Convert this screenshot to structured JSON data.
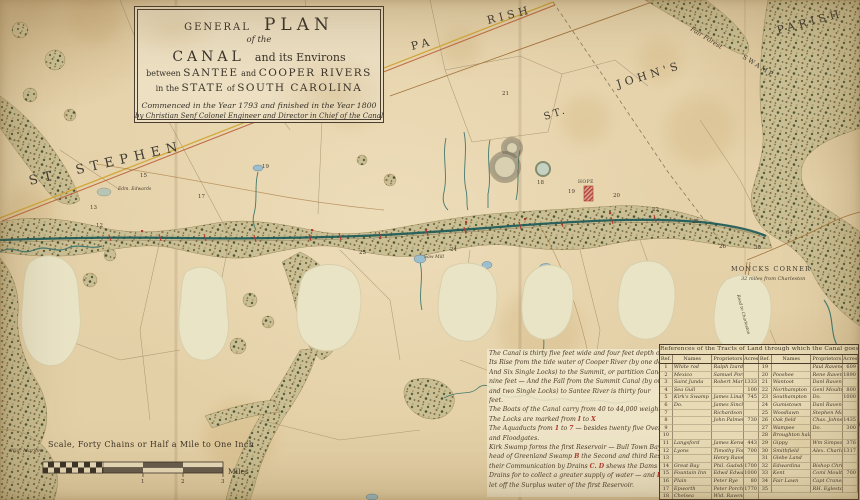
{
  "cartouche": {
    "l1a": "GENERAL",
    "l1b": "PLAN",
    "l2": "of the",
    "l3a": "CANAL",
    "l3b": "and its Environs",
    "l4a": "between",
    "l4b": "SANTEE",
    "l4c": "and",
    "l4d": "COOPER RIVERS",
    "l5a": "in the",
    "l5b": "STATE",
    "l5c": "of",
    "l5d": "SOUTH CAROLINA",
    "l6": "Commenced in the Year 1793 and finished in the Year 1800",
    "l7": "by Christian Senf Colonel Engineer and Director in Chief of the Canal"
  },
  "map_labels": [
    {
      "text": "ST. STEPHEN"
    },
    {
      "text": "PA"
    },
    {
      "text": "RISH"
    },
    {
      "text": "ST."
    },
    {
      "text": "JOHN'S"
    },
    {
      "text": "PARISH"
    },
    {
      "text": "Fair Forest"
    },
    {
      "text": "SWAMP"
    },
    {
      "text": "MONCKS CORNER"
    },
    {
      "text": "32 miles from Charleston"
    },
    {
      "text": "Road to Charleston"
    },
    {
      "text": "Edm. Edwards"
    },
    {
      "text": "Saw Mill"
    },
    {
      "text": "HOPE"
    },
    {
      "text": "Wid. Marion"
    }
  ],
  "tract_numbers": [
    {
      "n": "12",
      "x": 96,
      "y": 227
    },
    {
      "n": "13",
      "x": 90,
      "y": 209
    },
    {
      "n": "15",
      "x": 140,
      "y": 177
    },
    {
      "n": "17",
      "x": 198,
      "y": 198
    },
    {
      "n": "19",
      "x": 262,
      "y": 168
    },
    {
      "n": "21",
      "x": 502,
      "y": 95
    },
    {
      "n": "18",
      "x": 537,
      "y": 184
    },
    {
      "n": "19",
      "x": 568,
      "y": 193
    },
    {
      "n": "20",
      "x": 613,
      "y": 197
    },
    {
      "n": "22",
      "x": 652,
      "y": 211
    },
    {
      "n": "23",
      "x": 359,
      "y": 254
    },
    {
      "n": "24",
      "x": 450,
      "y": 251
    },
    {
      "n": "25",
      "x": 692,
      "y": 223
    },
    {
      "n": "26",
      "x": 719,
      "y": 248
    },
    {
      "n": "30",
      "x": 754,
      "y": 249
    },
    {
      "n": "34",
      "x": 786,
      "y": 234
    }
  ],
  "notes": {
    "lines": [
      [
        {
          "t": "The Canal is thirty five feet wide and four feet depth of water."
        }
      ],
      [
        {
          "t": "Its Rise from the tide water of Cooper River (by one double"
        }
      ],
      [
        {
          "t": "And Six Single Locks) to the Summit, or partition Canal is Sixty"
        }
      ],
      [
        {
          "t": "nine feet — And the Fall from the Summit Canal (by one double"
        }
      ],
      [
        {
          "t": "and two Single Locks) to Santee River is thirty four"
        }
      ],
      [
        {
          "t": "feet."
        }
      ],
      [
        {
          "t": "The Boats of the Canal carry from 40 to 44,000 weight."
        }
      ],
      [
        {
          "t": "The Locks are marked from "
        },
        {
          "t": "I",
          "r": 1
        },
        {
          "t": " to "
        },
        {
          "t": "X",
          "r": 1
        }
      ],
      [
        {
          "t": "The Aquaducts from "
        },
        {
          "t": "1",
          "r": 1
        },
        {
          "t": " to "
        },
        {
          "t": "7",
          "r": 1
        },
        {
          "t": " — besides twenty five Overfalls"
        }
      ],
      [
        {
          "t": "and Floodgates."
        }
      ],
      [
        {
          "t": "Kirk Swamp forms the first Reservoir — Bull Town Bays and the"
        }
      ],
      [
        {
          "t": "head of Greenland Swamp "
        },
        {
          "t": "B",
          "r": 1
        },
        {
          "t": " the Second and third Reservoir"
        }
      ],
      [
        {
          "t": "their Communication by Drains "
        },
        {
          "t": "C. D",
          "r": 1
        },
        {
          "t": " shews the Dams and "
        },
        {
          "t": "C",
          "r": 1
        },
        {
          "t": " the"
        }
      ],
      [
        {
          "t": "Drains for to collect a greater supply of water — and "
        },
        {
          "t": "E",
          "r": 1
        },
        {
          "t": " the Drain to"
        }
      ],
      [
        {
          "t": "let off the Surplus water of the first Reservoir."
        }
      ]
    ]
  },
  "reference_table": {
    "title": "References of the Tracts of Land through which the Canal goes",
    "columns": [
      "Ref.",
      "Names",
      "Proprietors",
      "Acres"
    ],
    "left_rows": [
      [
        "1",
        "White rod",
        "Ralph Izard Esq",
        ""
      ],
      [
        "2",
        "Mexico",
        "Samuel Porcher",
        ""
      ],
      [
        "3",
        "Saint Junda",
        "Robert Marion",
        "1333"
      ],
      [
        "4",
        "Sea Gull",
        "",
        "100"
      ],
      [
        "5",
        "Kirk's Swamp",
        "James Linah",
        "745"
      ],
      [
        "6",
        "Do.",
        "James Sinclair",
        ""
      ],
      [
        "7",
        "",
        "Richardson",
        ""
      ],
      [
        "8",
        "",
        "John Palmer",
        "730"
      ],
      [
        "9",
        "",
        "",
        ""
      ],
      [
        "10",
        "",
        "",
        ""
      ],
      [
        "11",
        "Langsford",
        "James Kenworth",
        "443"
      ],
      [
        "12",
        "Lyons",
        "Timothy Ford",
        "700"
      ],
      [
        "13",
        "",
        "Henry Ravenel",
        ""
      ],
      [
        "14",
        "Great Bay",
        "Phil. Gadsden",
        "1700"
      ],
      [
        "15",
        "Fountain Inn",
        "Edwd Edwards",
        "1000"
      ],
      [
        "16",
        "Plain",
        "Peter Rye",
        "80"
      ],
      [
        "17",
        "Epworth",
        "Peter Porcher",
        "1770"
      ],
      [
        "18",
        "Chelsea",
        "Wid. Ravenel",
        ""
      ]
    ],
    "right_rows": [
      [
        "19",
        "",
        "Paul Ravenel",
        "609"
      ],
      [
        "20",
        "Pooshee",
        "Rene Ravenel",
        "1890"
      ],
      [
        "21",
        "Wantoot",
        "Danl Ravenel",
        ""
      ],
      [
        "22",
        "Northampton",
        "Genl Moultrie",
        "800"
      ],
      [
        "23",
        "Southampton",
        "Do.",
        "1000"
      ],
      [
        "24",
        "Gumistown",
        "Danl Ravenel",
        ""
      ],
      [
        "25",
        "Woodlawn",
        "Stephen Mazyck",
        ""
      ],
      [
        "26",
        "Oak field",
        "Chas. Johnston",
        "1435"
      ],
      [
        "27",
        "Wampee",
        "Do.",
        "300"
      ],
      [
        "28",
        "Broughton hall",
        "",
        ""
      ],
      [
        "29",
        "Gippy",
        "Wm Simpson",
        "376"
      ],
      [
        "30",
        "Smithfield",
        "Alex. Charlot",
        "1317"
      ],
      [
        "31",
        "Glebe Land",
        "",
        ""
      ],
      [
        "32",
        "Edwardina",
        "Bishop Christie",
        ""
      ],
      [
        "33",
        "Kent",
        "Coml Moultrie",
        "700"
      ],
      [
        "34",
        "Fair Lawn",
        "Capt Cranes",
        ""
      ],
      [
        "35",
        "",
        "RH. Egleston",
        ""
      ]
    ]
  },
  "scale": {
    "caption": "Scale, Forty Chains or Half a Mile to One Inch",
    "tick1": "1",
    "tick2": "2",
    "tick3": "3",
    "miles": "Miles"
  },
  "colors": {
    "paper": "#e5d2aa",
    "patch": "#eae4c7",
    "ink": "#3c3226",
    "red_accent": "#b23a2e",
    "canal": "#1d5a57",
    "stream": "#44796f",
    "swamp_base": "#cabe94",
    "road_yellow": "#d2a93c",
    "road_red": "#b95a33",
    "water": "#9dbfcd",
    "boundary": "#a2906c"
  }
}
